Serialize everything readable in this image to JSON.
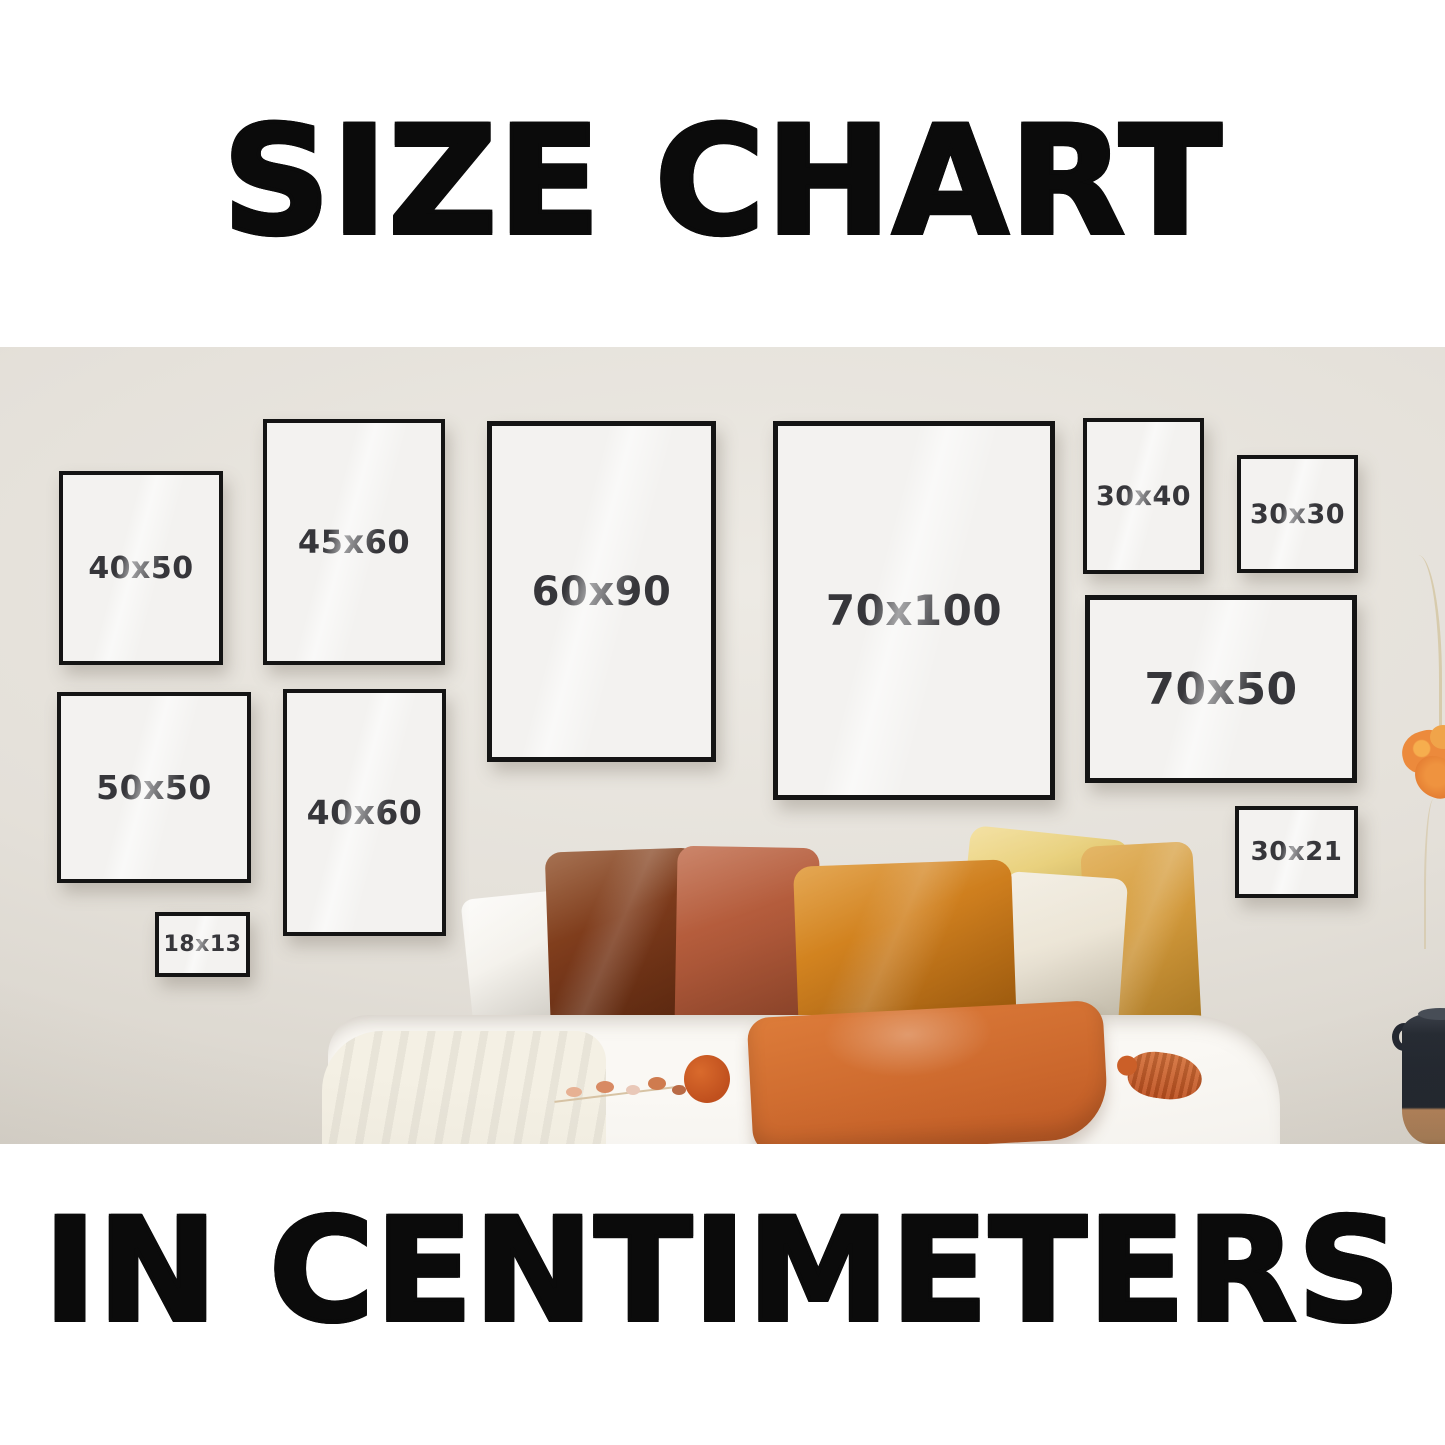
{
  "header": {
    "title": "SIZE CHART"
  },
  "footer": {
    "subtitle": "IN CENTIMETERS"
  },
  "frames": [
    {
      "id": "40x50",
      "label": "40x50"
    },
    {
      "id": "45x60",
      "label": "45x60"
    },
    {
      "id": "60x90",
      "label": "60x90"
    },
    {
      "id": "70x100",
      "label": "70x100"
    },
    {
      "id": "30x40",
      "label": "30x40"
    },
    {
      "id": "30x30",
      "label": "30x30"
    },
    {
      "id": "50x50",
      "label": "50x50"
    },
    {
      "id": "40x60",
      "label": "40x60"
    },
    {
      "id": "70x50",
      "label": "70x50"
    },
    {
      "id": "18x13",
      "label": "18x13"
    },
    {
      "id": "30x21",
      "label": "30x21"
    }
  ],
  "colors": {
    "heading_text": "#0b0b0b",
    "wall": "#e4e0d9",
    "frame_border": "#141414",
    "frame_fill": "#f3f2f0",
    "label_text": "#36363a",
    "bedding_white": "#faf8f4",
    "throw_cream": "#f4f0e4",
    "pillow_dark_rust": "#7c3a1b",
    "pillow_terracotta": "#b25a3a",
    "pillow_orange_velvet": "#cd7d1d",
    "pillow_cream": "#ece5d6",
    "pillow_mustard": "#d2993b",
    "pillow_yellow": "#e9d17e",
    "pillow_front_orange": "#d06d30",
    "tassel_orange": "#c0501e",
    "vase_dark": "#22272f",
    "vase_clay": "#b08058",
    "flower_orange": "#ec8a3c"
  }
}
